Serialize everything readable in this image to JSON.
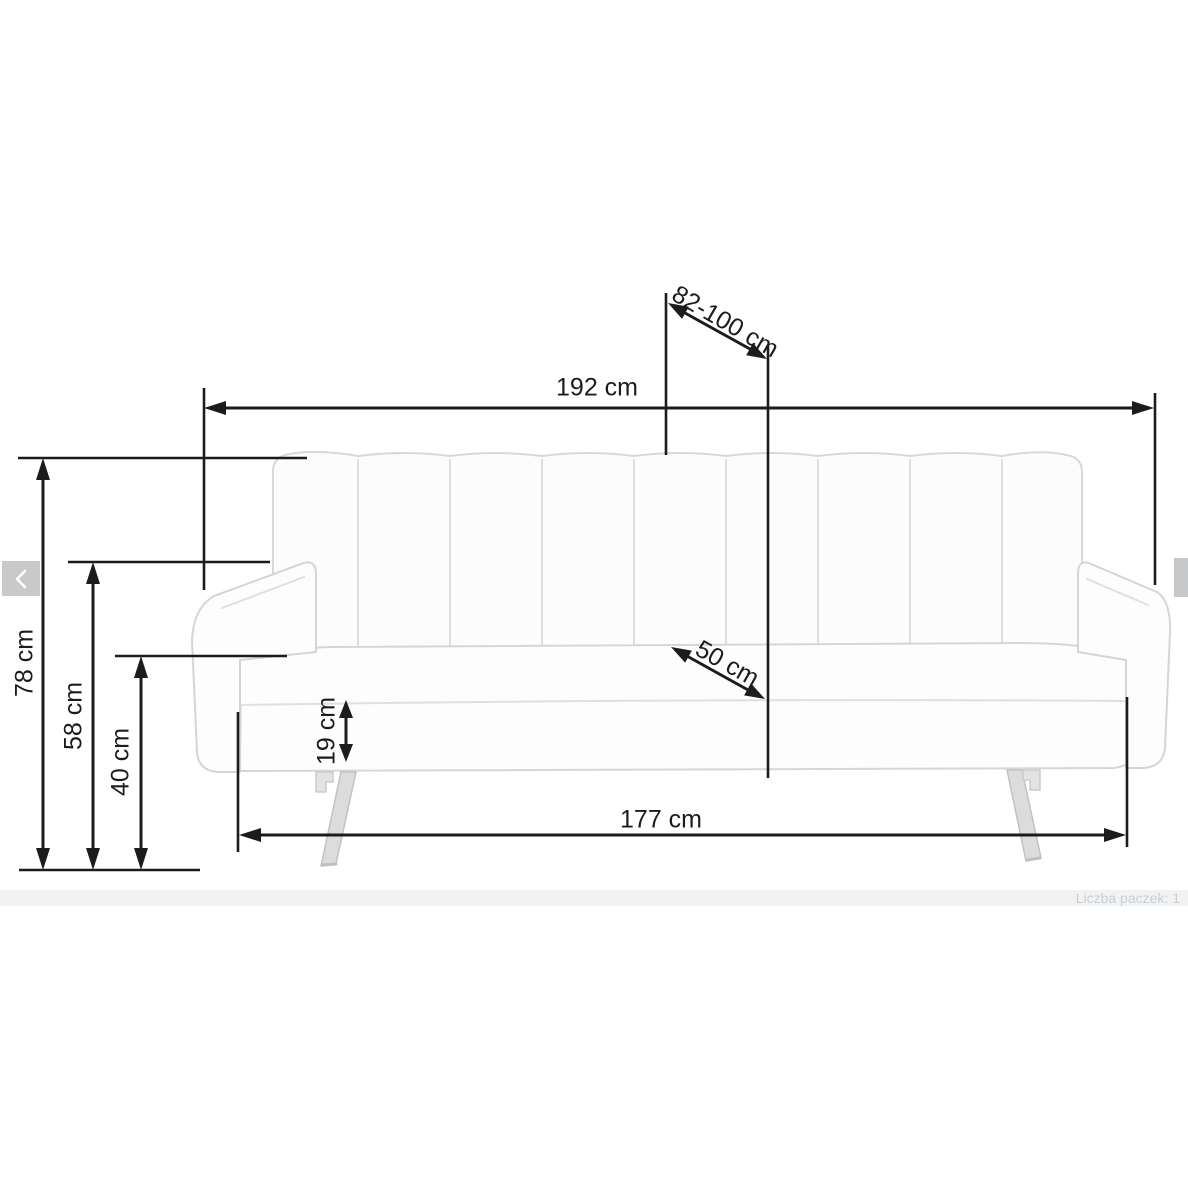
{
  "diagram": {
    "title_semantic": "sofa-bed dimension drawing",
    "dimensions": {
      "overall_width": "192 cm",
      "bed_depth_range": "82-100 cm",
      "overall_height": "78 cm",
      "armrest_height": "58 cm",
      "seat_height": "40 cm",
      "frame_height": "19 cm",
      "seat_depth": "50 cm",
      "base_width": "177 cm"
    }
  },
  "carousel": {
    "prev_icon": "chevron-left",
    "next_icon": "chevron-right-partial"
  },
  "footer": {
    "package_info": "Liczba paczek: 1"
  },
  "colors": {
    "dimension_line": "#1c1c1c",
    "sofa_outline": "#d6d6d6",
    "sofa_fill": "#fcfcfc",
    "leg_fill": "#dcdcdc",
    "nav_button": "#c9c9c9",
    "footer_band": "#f1f2f4",
    "footer_text": "#c9ced3"
  }
}
